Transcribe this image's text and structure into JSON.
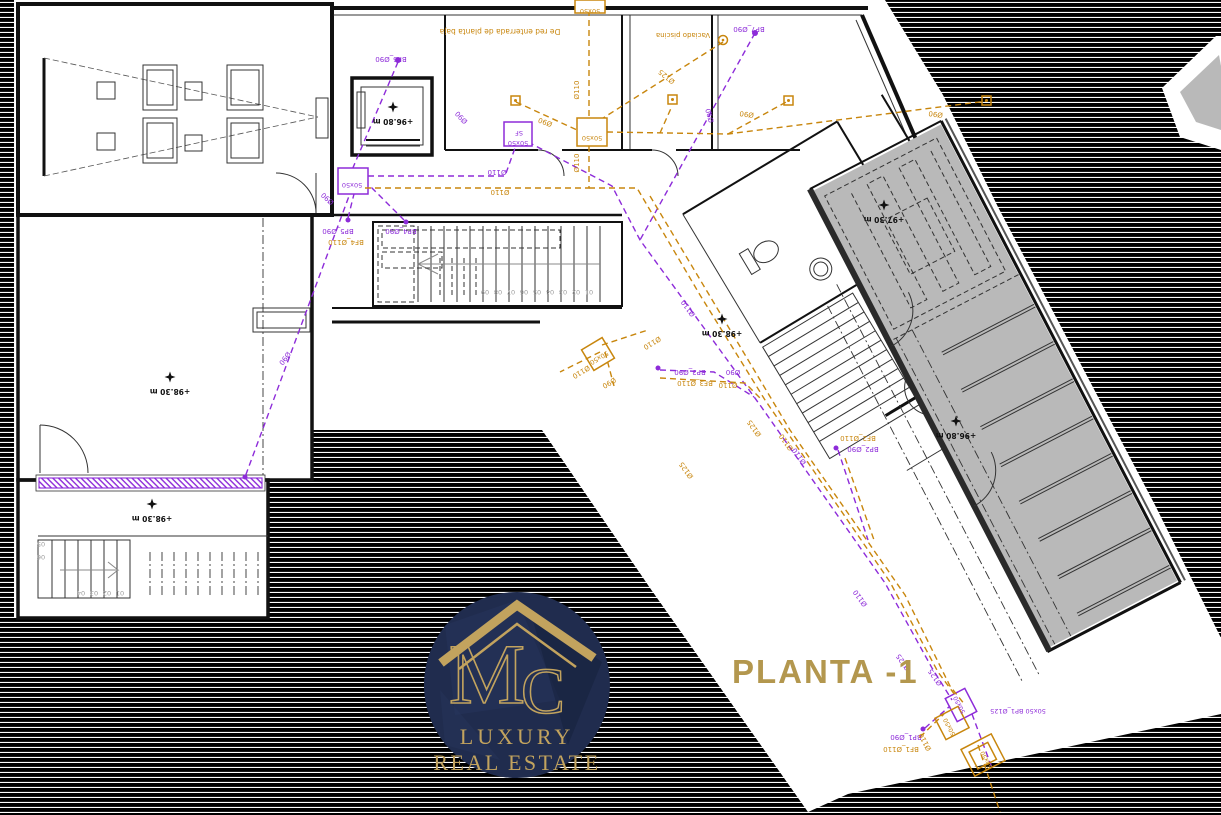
{
  "title": {
    "text": "PLANTA -1"
  },
  "logo": {
    "monogram_m": "M",
    "monogram_c": "C",
    "line1": "LUXURY",
    "line2": "REAL ESTATE"
  },
  "colors": {
    "purple": "#8d2bd9",
    "orange": "#c8860d",
    "gold": "#b3974e",
    "logo_gold": "#c2a35e",
    "navy": "#202c4e",
    "gray": "#b9b9b9"
  },
  "levels": [
    {
      "t": "+96.80 m",
      "x": 393,
      "y": 119
    },
    {
      "t": "+98.30 m",
      "x": 170,
      "y": 389
    },
    {
      "t": "+98.30 m",
      "x": 152,
      "y": 516
    },
    {
      "t": "+98.30 m",
      "x": 722,
      "y": 331
    },
    {
      "t": "+97.30 m",
      "x": 884,
      "y": 217
    },
    {
      "t": "+96.80 m",
      "x": 956,
      "y": 433
    }
  ],
  "labels": [
    {
      "t": "De red enterrada de planta baja",
      "x": 500,
      "y": 29,
      "r": 180,
      "c": "o",
      "s": 7.5
    },
    {
      "t": "Vaciado piscina",
      "x": 683,
      "y": 33,
      "r": 180,
      "c": "o",
      "s": 7
    },
    {
      "t": "BP6_Ø90",
      "x": 391,
      "y": 57,
      "r": 180,
      "c": "p",
      "s": 7
    },
    {
      "t": "Ø90",
      "x": 463,
      "y": 116,
      "r": 227,
      "c": "p",
      "s": 7
    },
    {
      "t": "Ø110",
      "x": 497,
      "y": 170,
      "r": 180,
      "c": "p",
      "s": 7
    },
    {
      "t": "Ø90",
      "x": 329,
      "y": 197,
      "r": 222,
      "c": "p",
      "s": 7
    },
    {
      "t": "Ø90",
      "x": 283,
      "y": 357,
      "r": 127,
      "c": "p",
      "s": 7
    },
    {
      "t": "BP5_Ø90",
      "x": 338,
      "y": 229,
      "r": 180,
      "c": "p",
      "s": 7
    },
    {
      "t": "BP4_Ø90",
      "x": 401,
      "y": 229,
      "r": 180,
      "c": "p",
      "s": 7
    },
    {
      "t": "BF4_Ø110",
      "x": 346,
      "y": 240,
      "r": 180,
      "c": "o",
      "s": 7
    },
    {
      "t": "BP7_Ø90",
      "x": 749,
      "y": 27,
      "r": 180,
      "c": "p",
      "s": 7
    },
    {
      "t": "Ø90",
      "x": 712,
      "y": 115,
      "r": 255,
      "c": "p",
      "s": 7
    },
    {
      "t": "Ø110",
      "x": 690,
      "y": 307,
      "r": 234,
      "c": "p",
      "s": 7
    },
    {
      "t": "Ø110",
      "x": 801,
      "y": 455,
      "r": 234,
      "c": "p",
      "s": 7
    },
    {
      "t": "Ø110",
      "x": 862,
      "y": 597,
      "r": 234,
      "c": "p",
      "s": 7
    },
    {
      "t": "BP3_Ø90",
      "x": 690,
      "y": 370,
      "r": 180,
      "c": "p",
      "s": 7
    },
    {
      "t": "Ø90",
      "x": 733,
      "y": 370,
      "r": 180,
      "c": "p",
      "s": 7
    },
    {
      "t": "BP2_Ø90",
      "x": 863,
      "y": 447,
      "r": 180,
      "c": "p",
      "s": 7
    },
    {
      "t": "Ø125",
      "x": 905,
      "y": 661,
      "r": 234,
      "c": "p",
      "s": 7
    },
    {
      "t": "Ø125",
      "x": 937,
      "y": 676,
      "r": 234,
      "c": "p",
      "s": 7
    },
    {
      "t": "50x50 BP1_Ø125",
      "x": 1018,
      "y": 709,
      "r": 180,
      "c": "p",
      "s": 6.5
    },
    {
      "t": "BP1_Ø90",
      "x": 906,
      "y": 735,
      "r": 180,
      "c": "p",
      "s": 7
    },
    {
      "t": "50x50",
      "x": 352,
      "y": 183,
      "r": 180,
      "c": "p",
      "s": 6.5
    },
    {
      "t": "50x50",
      "x": 518,
      "y": 141,
      "r": 180,
      "c": "p",
      "s": 6.5
    },
    {
      "t": "SF",
      "x": 519,
      "y": 131,
      "r": 180,
      "c": "p",
      "s": 6.5
    },
    {
      "t": "50x50",
      "x": 961,
      "y": 704,
      "r": 242,
      "c": "p",
      "s": 6
    },
    {
      "t": "Ø110",
      "x": 579,
      "y": 90,
      "r": 270,
      "c": "o",
      "s": 7
    },
    {
      "t": "Ø125",
      "x": 668,
      "y": 75,
      "r": 218,
      "c": "o",
      "s": 7
    },
    {
      "t": "Ø90",
      "x": 546,
      "y": 120,
      "r": 200,
      "c": "o",
      "s": 7
    },
    {
      "t": "Ø90",
      "x": 747,
      "y": 112,
      "r": 188,
      "c": "o",
      "s": 7
    },
    {
      "t": "Ø90",
      "x": 936,
      "y": 112,
      "r": 188,
      "c": "o",
      "s": 7
    },
    {
      "t": "Ø110",
      "x": 579,
      "y": 163,
      "r": 270,
      "c": "o",
      "s": 7
    },
    {
      "t": "Ø110",
      "x": 500,
      "y": 190,
      "r": 180,
      "c": "o",
      "s": 7
    },
    {
      "t": "Ø110",
      "x": 651,
      "y": 341,
      "r": 149,
      "c": "o",
      "s": 7
    },
    {
      "t": "Ø110",
      "x": 580,
      "y": 370,
      "r": 149,
      "c": "o",
      "s": 7
    },
    {
      "t": "Ø90",
      "x": 608,
      "y": 381,
      "r": 149,
      "c": "o",
      "s": 7
    },
    {
      "t": "BF3_Ø110",
      "x": 695,
      "y": 381,
      "r": 180,
      "c": "o",
      "s": 7
    },
    {
      "t": "Ø110",
      "x": 728,
      "y": 383,
      "r": 180,
      "c": "o",
      "s": 7
    },
    {
      "t": "Ø125",
      "x": 688,
      "y": 469,
      "r": 234,
      "c": "o",
      "s": 7
    },
    {
      "t": "Ø110",
      "x": 788,
      "y": 441,
      "r": 234,
      "c": "o",
      "s": 7
    },
    {
      "t": "Ø125",
      "x": 756,
      "y": 427,
      "r": 234,
      "c": "o",
      "s": 7
    },
    {
      "t": "BF2_Ø110",
      "x": 858,
      "y": 436,
      "r": 180,
      "c": "o",
      "s": 7
    },
    {
      "t": "BF1_Ø110",
      "x": 901,
      "y": 747,
      "r": 180,
      "c": "o",
      "s": 7
    },
    {
      "t": "Ø110",
      "x": 927,
      "y": 741,
      "r": 242,
      "c": "o",
      "s": 7
    },
    {
      "t": "50x50",
      "x": 592,
      "y": 136,
      "r": 180,
      "c": "o",
      "s": 6.5
    },
    {
      "t": "50x50",
      "x": 590,
      "y": 9,
      "r": 180,
      "c": "o",
      "s": 6.5
    },
    {
      "t": "50x50",
      "x": 598,
      "y": 356,
      "r": 149,
      "c": "o",
      "s": 6.5
    },
    {
      "t": "50x50",
      "x": 951,
      "y": 726,
      "r": 242,
      "c": "o",
      "s": 6
    },
    {
      "t": "50x50",
      "x": 988,
      "y": 759,
      "r": 242,
      "c": "o",
      "s": 6
    },
    {
      "t": "01",
      "x": 589,
      "y": 290,
      "r": 180,
      "c": "g",
      "s": 6.5
    },
    {
      "t": "02",
      "x": 576,
      "y": 290,
      "r": 180,
      "c": "g",
      "s": 6.5
    },
    {
      "t": "03",
      "x": 563,
      "y": 290,
      "r": 180,
      "c": "g",
      "s": 6.5
    },
    {
      "t": "04",
      "x": 550,
      "y": 290,
      "r": 180,
      "c": "g",
      "s": 6.5
    },
    {
      "t": "05",
      "x": 537,
      "y": 290,
      "r": 180,
      "c": "g",
      "s": 6.5
    },
    {
      "t": "06",
      "x": 524,
      "y": 290,
      "r": 180,
      "c": "g",
      "s": 6.5
    },
    {
      "t": "07",
      "x": 511,
      "y": 290,
      "r": 180,
      "c": "g",
      "s": 6.5
    },
    {
      "t": "08",
      "x": 498,
      "y": 290,
      "r": 180,
      "c": "g",
      "s": 6.5
    },
    {
      "t": "09",
      "x": 485,
      "y": 290,
      "r": 180,
      "c": "g",
      "s": 6.5
    },
    {
      "t": "01",
      "x": 120,
      "y": 591,
      "r": 180,
      "c": "g",
      "s": 6.5
    },
    {
      "t": "02",
      "x": 107,
      "y": 591,
      "r": 180,
      "c": "g",
      "s": 6.5
    },
    {
      "t": "03",
      "x": 94,
      "y": 591,
      "r": 180,
      "c": "g",
      "s": 6.5
    },
    {
      "t": "04",
      "x": 81,
      "y": 591,
      "r": 180,
      "c": "g",
      "s": 6.5
    },
    {
      "t": "05",
      "x": 41,
      "y": 542,
      "r": 180,
      "c": "g",
      "s": 6.5
    },
    {
      "t": "06",
      "x": 41,
      "y": 555,
      "r": 180,
      "c": "g",
      "s": 6.5
    }
  ]
}
